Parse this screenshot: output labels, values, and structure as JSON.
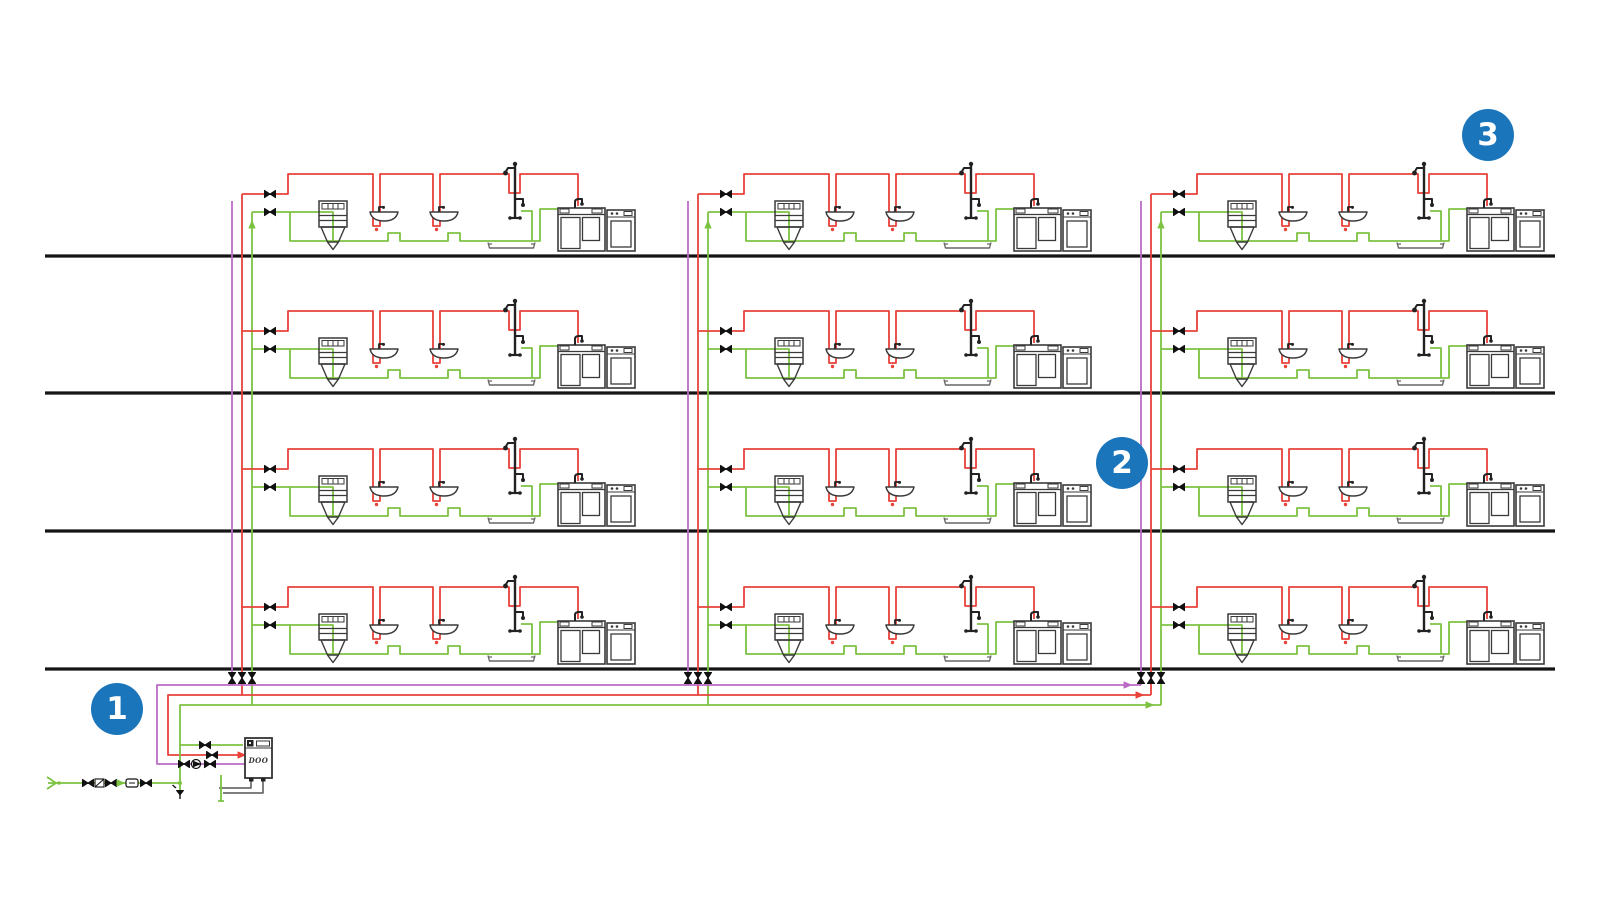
{
  "diagram": {
    "kind": "plumbing-schematic",
    "floors": {
      "count": 4,
      "y_positions": [
        256,
        393,
        531,
        669
      ],
      "x_start": 45,
      "x_end": 1555
    },
    "risers": {
      "x_positions": [
        232,
        688,
        1141
      ],
      "pipes": [
        "circulation",
        "hot-water",
        "cold-water"
      ]
    },
    "apartments_per_floor": 3,
    "apartments_total": 12,
    "mains": {
      "circulation_y": 685,
      "hot_y": 695,
      "cold_y": 705,
      "left_x": 157,
      "right_x": 1163
    },
    "colors": {
      "hot_water": "#e8423a",
      "cold_water": "#7dc242",
      "circulation": "#bb6bc4",
      "floor_line": "#151515",
      "fixture": "#3a3a3a",
      "equipment": "#333333",
      "badge_blue": "#1b75bb",
      "background": "#ffffff"
    }
  },
  "badges": [
    {
      "label": "1",
      "x": 117,
      "y": 709
    },
    {
      "label": "2",
      "x": 1122,
      "y": 463
    },
    {
      "label": "3",
      "x": 1488,
      "y": 135
    }
  ],
  "equipment": {
    "heater_label": "DOO"
  }
}
